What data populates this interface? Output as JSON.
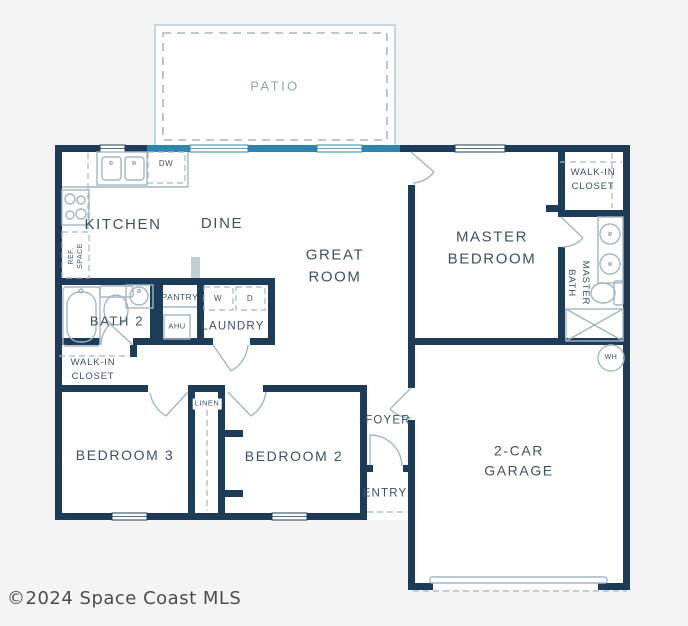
{
  "page": {
    "background": "#f4f4f4"
  },
  "plan": {
    "colors": {
      "wall": "#1d3c59",
      "slider": "#2e86ae",
      "fixture": "#a4b6c2",
      "label": "#3d5166",
      "patio_line": "#bfd8e1",
      "patio_dash": "#97a8b2",
      "patio_label": "#8aa7b5"
    },
    "rooms": {
      "patio": "PATIO",
      "kitchen": "KITCHEN",
      "dine": "DINE",
      "great_room": "GREAT\nROOM",
      "master_bedroom": "MASTER\nBEDROOM",
      "walkin_closet_right": "WALK-IN\nCLOSET",
      "master_bath": "MASTER\nBATH",
      "bath2": "BATH 2",
      "pantry": "PANTRY",
      "laundry": "LAUNDRY",
      "walkin_closet_left": "WALK-IN\nCLOSET",
      "bedroom3": "BEDROOM 3",
      "bedroom2": "BEDROOM 2",
      "linen": "LINEN",
      "foyer": "FOYER",
      "entry": "ENTRY",
      "garage": "2-CAR\nGARAGE"
    },
    "fixtures": {
      "dishwasher": "DW",
      "washer": "W",
      "dryer": "D",
      "ahu": "AHU",
      "water_heater": "WH",
      "ref_space": "REF.\nSPACE"
    }
  },
  "footer": {
    "copyright": "©2024 Space Coast MLS"
  }
}
